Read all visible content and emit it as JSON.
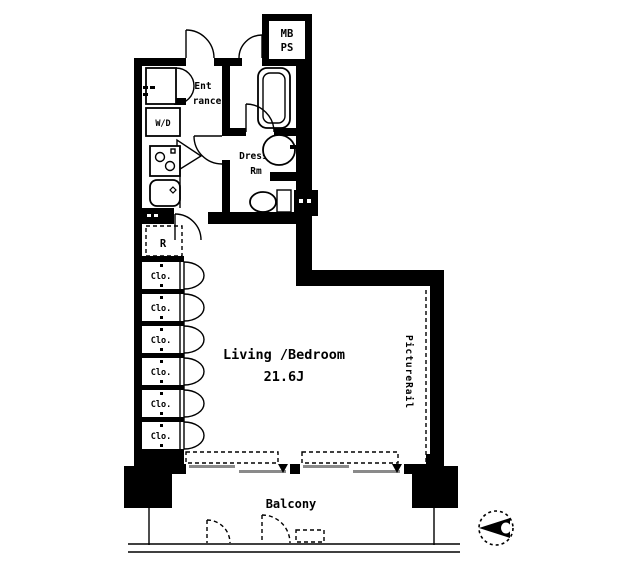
{
  "labels": {
    "meter_box_line1": "MB",
    "meter_box_line2": "PS",
    "entrance_line1": "Ent",
    "entrance_line2": "rance",
    "bath": "Bath",
    "washer_dryer": "W/D",
    "dressing_room_line1": "Dressing",
    "dressing_room_line2": "Rm",
    "refrigerator": "R",
    "living_bedroom_name": "Living /Bedroom",
    "living_bedroom_size": "21.6J",
    "picture_rail": "PictureRail",
    "balcony": "Balcony"
  },
  "closets": [
    "Clo.",
    "Clo.",
    "Clo.",
    "Clo.",
    "Clo.",
    "Clo."
  ],
  "colors": {
    "line": "#000000",
    "background": "#ffffff",
    "window_pane": "#8a8a8a"
  }
}
